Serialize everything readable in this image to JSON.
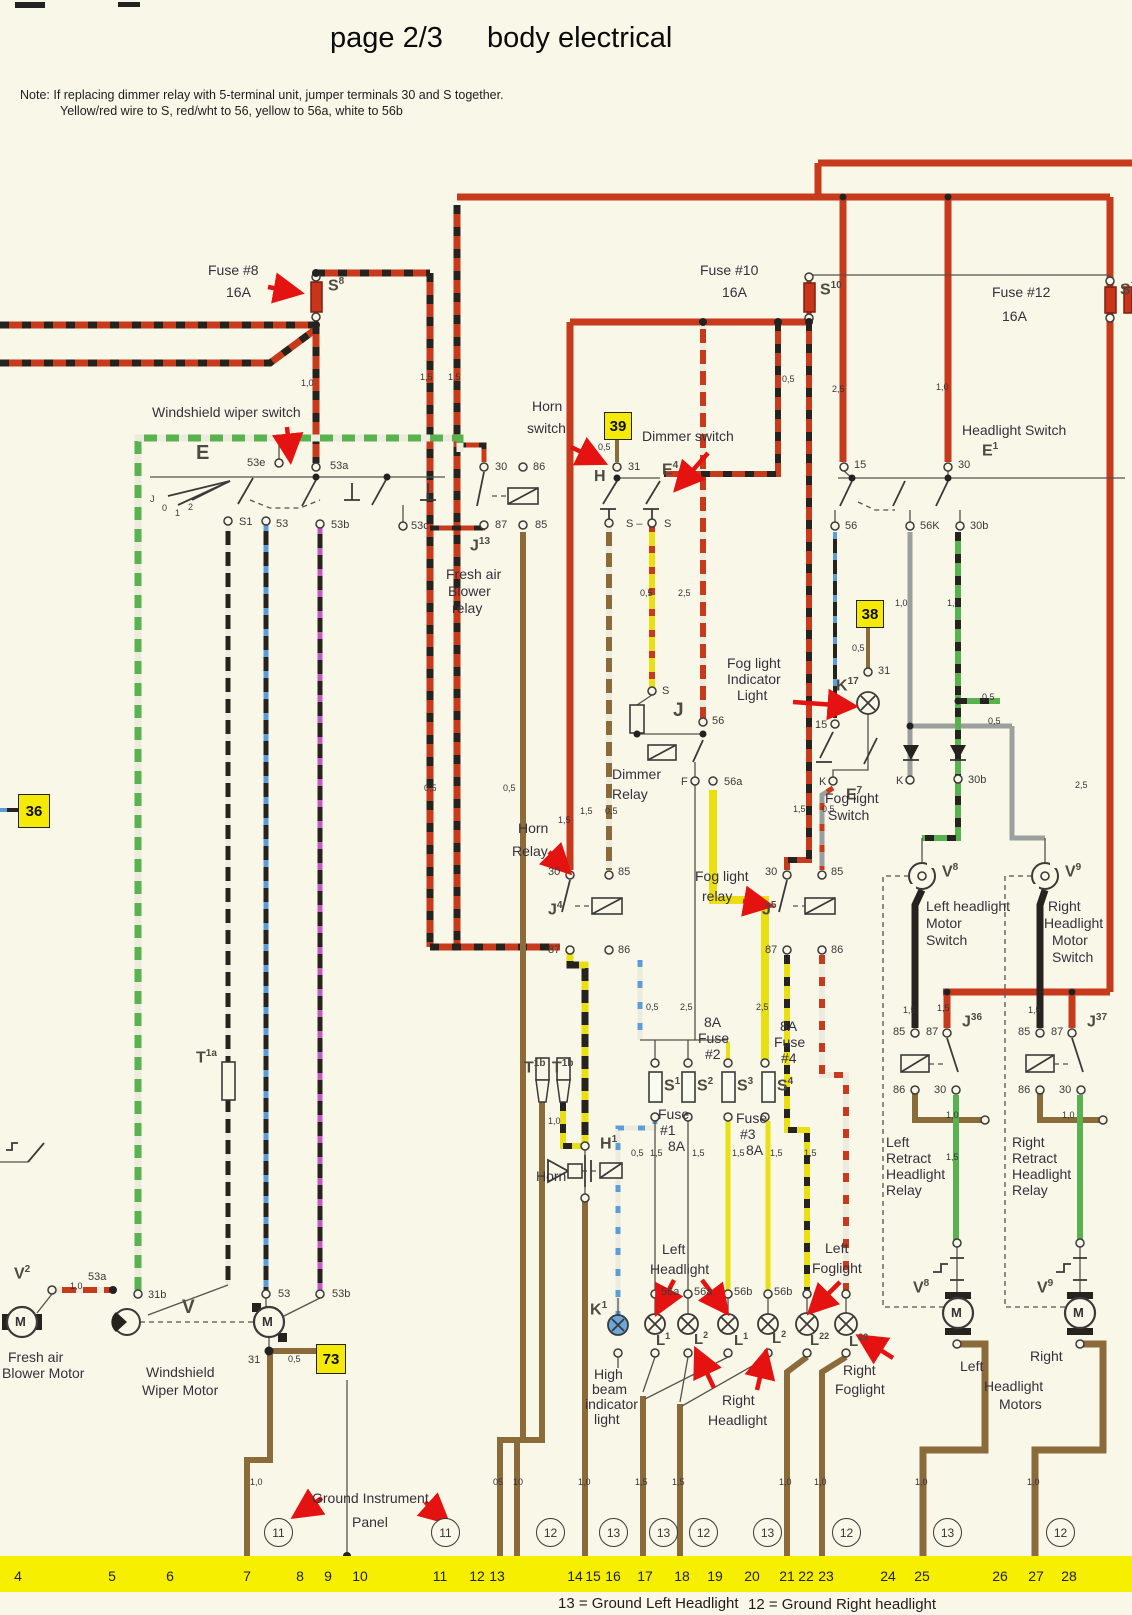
{
  "title_left": "page 2/3",
  "title_right": "body electrical",
  "note1": "Note: If replacing dimmer relay with 5-terminal unit, jumper terminals 30 and S together.",
  "note2": "Yellow/red wire to S, red/wht to 56, yellow to 56a, white to 56b",
  "labels": {
    "fuse8": "Fuse #8",
    "fuse10": "Fuse #10",
    "fuse12": "Fuse #12",
    "a16": "16A",
    "a8": "8A",
    "fuse": "Fuse",
    "n1": "#1",
    "n2": "#2",
    "n3": "#3",
    "n4": "#4",
    "wiper_switch": "Windshield wiper switch",
    "horn": "Horn",
    "switch_lc": "switch",
    "switch": "Switch",
    "dimmer_switch": "Dimmer switch",
    "headlight_switch": "Headlight Switch",
    "fresh_air": "Fresh air",
    "blower": "Blower",
    "relay_lc": "relay",
    "relay": "Relay",
    "dimmer": "Dimmer",
    "fog_light": "Fog light",
    "indicator": "Indicator",
    "light": "Light",
    "left_headlight": "Left headlight",
    "motor": "Motor",
    "right": "Right",
    "left": "Left",
    "headlight": "Headlight",
    "retract": "Retract",
    "high": "High",
    "beam": "beam",
    "indicator_lc": "indicator",
    "light_lc": "light",
    "foglight": "Foglight",
    "motors": "Motors",
    "blower_motor": "Blower Motor",
    "windshield": "Windshield",
    "wiper_motor": "Wiper Motor"
  },
  "sym": {
    "s": "S",
    "j": "J",
    "e": "E",
    "h": "H",
    "k": "K",
    "l": "L",
    "v": "V",
    "t": "T",
    "m": "M"
  },
  "sup": {
    "f8": "8",
    "f10": "10",
    "f12": "12",
    "s1": "1",
    "s2": "2",
    "s3": "3",
    "s4": "4",
    "j13": "13",
    "j4": "4",
    "j5": "5",
    "j36": "36",
    "j37": "37",
    "e1": "1",
    "e4": "4",
    "e7": "7",
    "k17": "17",
    "k1": "1",
    "v8": "8",
    "v9": "9",
    "v2": "2",
    "t1a": "1a",
    "t1b": "1b",
    "h1": "1",
    "l1": "1",
    "l2": "2",
    "l22": "22",
    "l23": "23"
  },
  "term": {
    "t30": "30",
    "t31": "31",
    "t15": "15",
    "t56": "56",
    "t56k": "56K",
    "t56a": "56a",
    "t56b": "56b",
    "t30b": "30b",
    "t85": "85",
    "t86": "86",
    "t87": "87",
    "t53": "53",
    "t53a": "53a",
    "t53b": "53b",
    "t53c": "53c",
    "t53e": "53e",
    "t31b": "31b",
    "ts1": "S1",
    "ts": "S",
    "tsm": "S –",
    "tf": "F",
    "tk": "K",
    "tj": "J",
    "t0": "0",
    "t1": "1",
    "t2": "2"
  },
  "sizes": {
    "s05": "0,5",
    "s10": "1,0",
    "s15": "1,5",
    "s25": "2,5",
    "b05": "05",
    "b10": "10"
  },
  "boxes": {
    "b36": "36",
    "b38": "38",
    "b39": "39",
    "b73": "73"
  },
  "ground": {
    "panel1": "Ground Instrument",
    "panel2": "Panel",
    "legend13": "13 = Ground Left Headlight",
    "legend12": "12 = Ground  Right headlight",
    "bar": [
      "4",
      "5",
      "6",
      "7",
      "8",
      "9",
      "10",
      "11",
      "12",
      "13",
      "14",
      "15",
      "16",
      "17",
      "18",
      "19",
      "20",
      "21",
      "22",
      "23",
      "24",
      "25",
      "26",
      "27",
      "28"
    ],
    "circles": [
      "11",
      "11",
      "12",
      "13",
      "13",
      "12",
      "13",
      "12",
      "13",
      "12"
    ]
  },
  "colors": {
    "paper": "#f9f7e8",
    "wire_red": "#c83a1c",
    "wire_yellow": "#eadf12",
    "wire_green": "#58b24e",
    "wire_brown": "#8c6b3a",
    "bar_yellow": "#f6ef00",
    "annotation_red": "#e51212",
    "box_yellow": "#f4ea05",
    "high_beam_blue": "#69a8da"
  }
}
